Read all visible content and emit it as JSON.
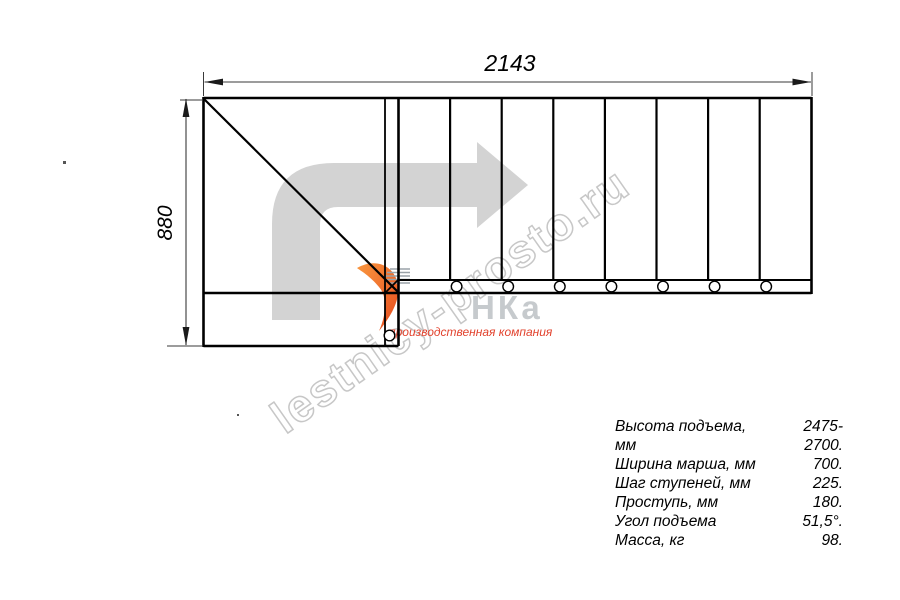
{
  "drawing": {
    "title": "stair-plan-top-view",
    "dim_width_label": "2143",
    "dim_height_label": "880",
    "straight_treads_count": 8,
    "baluster_count_flight": 7,
    "baluster_count_bottom": 1
  },
  "specs": {
    "rows": [
      {
        "label": "Высота подъема, мм",
        "value": "2475-2700."
      },
      {
        "label": "Ширина марша, мм",
        "value": "700."
      },
      {
        "label": "Шаг ступеней, мм",
        "value": "225."
      },
      {
        "label": "Проступь, мм",
        "value": "180."
      },
      {
        "label": "Угол подъема",
        "value": "51,5°."
      },
      {
        "label": "Масса, кг",
        "value": "98."
      }
    ]
  },
  "watermark": {
    "site": "lestnicy-prosto.ru",
    "logo_letters": "НКа",
    "tagline": "производственная компания"
  },
  "colors": {
    "line": "#000000",
    "dimension_line": "#3a3a3a",
    "watermark_arrow": "#d3d3d3",
    "watermark_outline": "#c7c7c7",
    "logo_letters_gray": "#c6cacd",
    "tagline_red": "#e2432e",
    "logo_orange_light": "#f9973f",
    "logo_orange_dark": "#e64b1e",
    "speed_lines_gray": "#9aa2a8"
  }
}
